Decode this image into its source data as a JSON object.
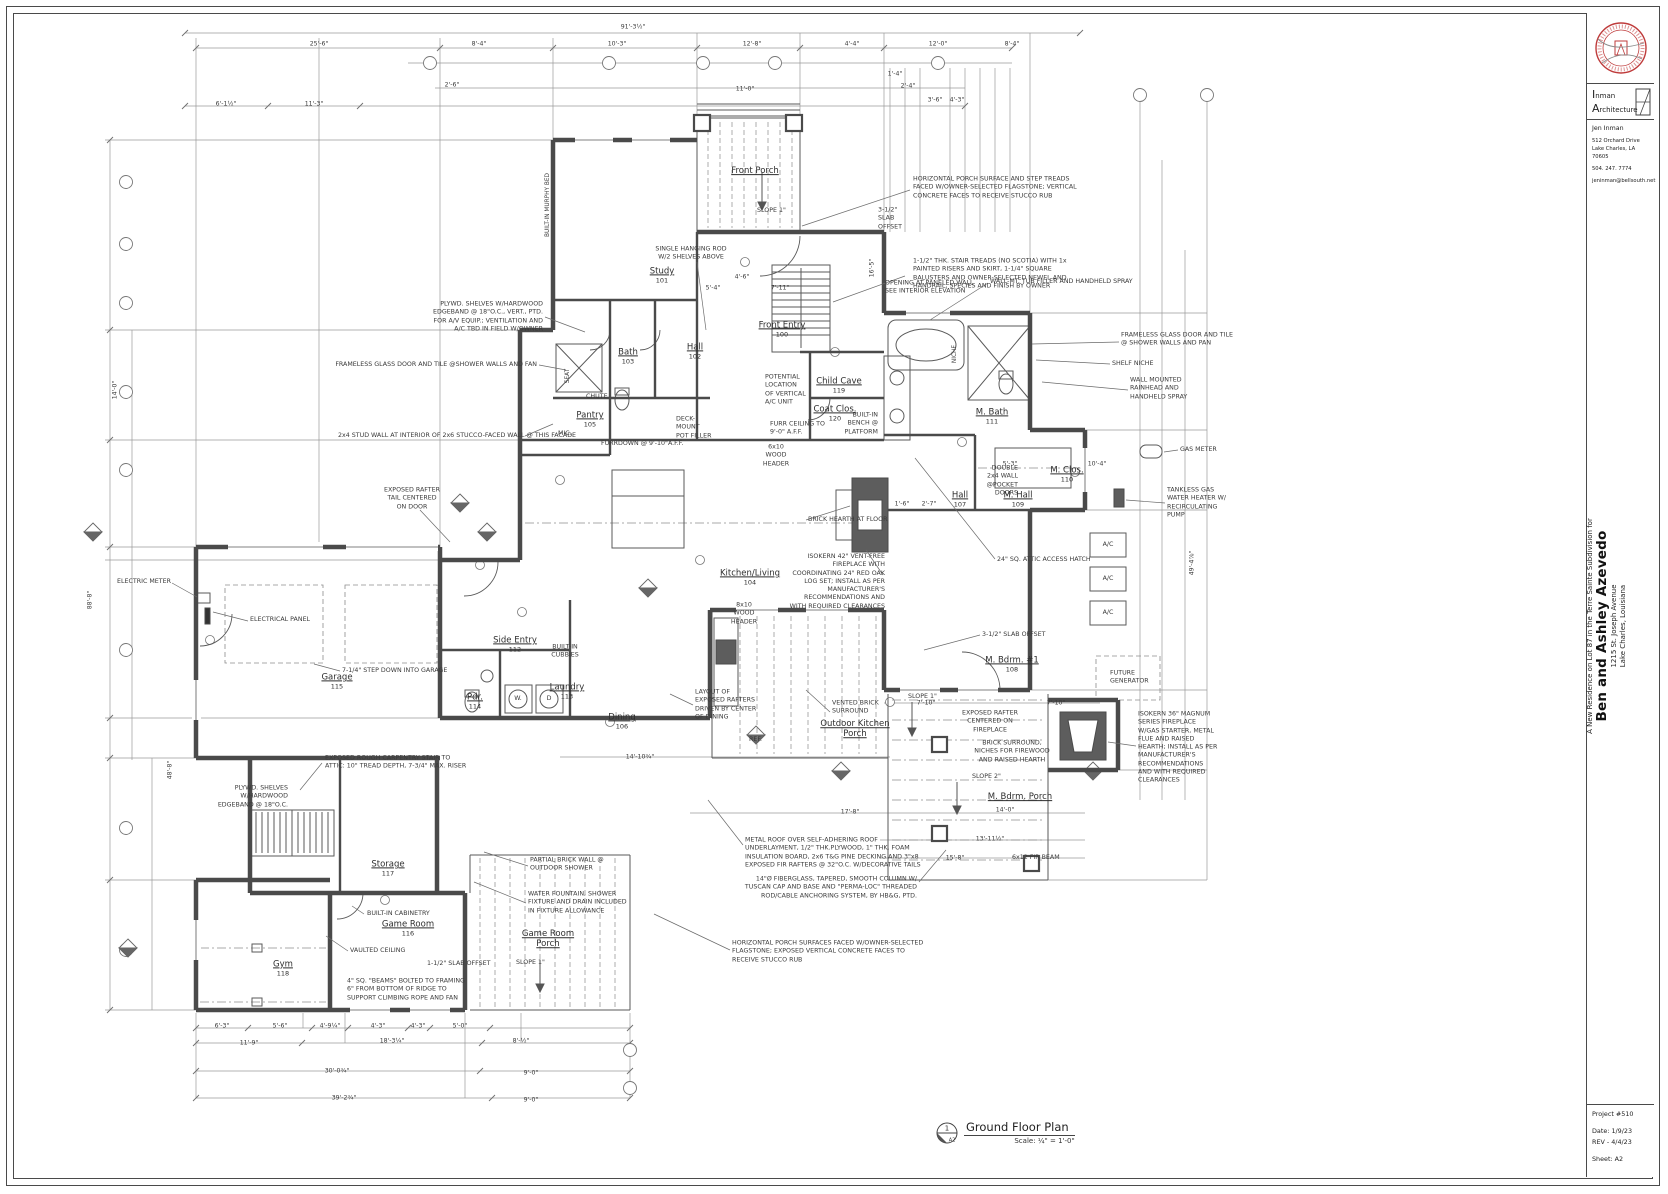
{
  "title_block": {
    "firm_line1": "Inman",
    "firm_line2": "Architecture",
    "architect": "Jen Inman",
    "address1": "512 Orchard Drive",
    "address2": "Lake Charles, LA  70605",
    "phone": "504. 247. 7774",
    "email": "jeninman@bellsouth.net",
    "project_intro": "A New Residence on Lot 87 in the Terre Sainte Subdivision for",
    "client": "Ben and Ashley Azevedo",
    "project_address1": "1215 St. Joseph Avenue",
    "project_address2": "Lake Charles, Louisiana",
    "project_number": "Project #510",
    "date_label": "Date:  1/9/23",
    "rev_label": "REV - 4/4/23",
    "sheet_label": "Sheet:  A2",
    "seal_color": "#bf3b3b"
  },
  "drawing_title": {
    "tag_number": "1",
    "tag_sheet": "A2",
    "title": "Ground Floor Plan",
    "scale": "Scale: ¼\" = 1'-0\""
  },
  "plan": {
    "rooms": [
      {
        "l": [
          "Front Porch"
        ],
        "n": "",
        "x": 755,
        "y": 172
      },
      {
        "l": [
          "Front Entry"
        ],
        "n": "100",
        "x": 782,
        "y": 330
      },
      {
        "l": [
          "Study"
        ],
        "n": "101",
        "x": 662,
        "y": 276
      },
      {
        "l": [
          "Hall"
        ],
        "n": "102",
        "x": 695,
        "y": 352
      },
      {
        "l": [
          "Bath"
        ],
        "n": "103",
        "x": 628,
        "y": 357
      },
      {
        "l": [
          "Kitchen/Living"
        ],
        "n": "104",
        "x": 750,
        "y": 578
      },
      {
        "l": [
          "Pantry"
        ],
        "n": "105",
        "x": 590,
        "y": 420
      },
      {
        "l": [
          "Dining"
        ],
        "n": "106",
        "x": 622,
        "y": 722
      },
      {
        "l": [
          "Hall"
        ],
        "n": "107",
        "x": 960,
        "y": 500
      },
      {
        "l": [
          "M. Bdrm. #1"
        ],
        "n": "108",
        "x": 1012,
        "y": 665
      },
      {
        "l": [
          "M. Hall"
        ],
        "n": "109",
        "x": 1018,
        "y": 500
      },
      {
        "l": [
          "M. Clos."
        ],
        "n": "110",
        "x": 1067,
        "y": 475
      },
      {
        "l": [
          "M. Bath"
        ],
        "n": "111",
        "x": 992,
        "y": 417
      },
      {
        "l": [
          "Side Entry"
        ],
        "n": "112",
        "x": 515,
        "y": 645
      },
      {
        "l": [
          "Laundry"
        ],
        "n": "113",
        "x": 567,
        "y": 692
      },
      {
        "l": [
          "Pdr."
        ],
        "n": "114",
        "x": 475,
        "y": 702
      },
      {
        "l": [
          "Garage"
        ],
        "n": "115",
        "x": 337,
        "y": 682
      },
      {
        "l": [
          "Game Room"
        ],
        "n": "116",
        "x": 408,
        "y": 929
      },
      {
        "l": [
          "Storage"
        ],
        "n": "117",
        "x": 388,
        "y": 869
      },
      {
        "l": [
          "Gym"
        ],
        "n": "118",
        "x": 283,
        "y": 969
      },
      {
        "l": [
          "Child Cave"
        ],
        "n": "119",
        "x": 839,
        "y": 386
      },
      {
        "l": [
          "Coat Clos."
        ],
        "n": "120",
        "x": 835,
        "y": 414
      },
      {
        "l": [
          "Outdoor Kitchen",
          "Porch"
        ],
        "n": "",
        "x": 855,
        "y": 730
      },
      {
        "l": [
          "Game Room",
          "Porch"
        ],
        "n": "",
        "x": 548,
        "y": 940
      },
      {
        "l": [
          "M. Bdrm. Porch"
        ],
        "n": "",
        "x": 1020,
        "y": 798
      }
    ],
    "annotations": [
      {
        "l": [
          "SINGLE HANGING ROD",
          "W/2 SHELVES ABOVE"
        ],
        "x": 691,
        "y": 254,
        "a": "c"
      },
      {
        "l": [
          "PLYWD. SHELVES W/HARDWOOD",
          "EDGEBAND @ 18\"O.C., VERT., PTD.",
          "FOR A/V EQUIP.; VENTILATION AND",
          "A/C TBD IN FIELD W/OWNER"
        ],
        "x": 543,
        "y": 317,
        "a": "r"
      },
      {
        "l": [
          "FRAMELESS GLASS DOOR AND TILE @SHOWER WALLS AND FAN"
        ],
        "x": 537,
        "y": 365,
        "a": "r"
      },
      {
        "l": [
          "2x4 STUD WALL AT INTERIOR OF 2x6 STUCCO-FACED WALL @ THIS FACADE"
        ],
        "x": 338,
        "y": 436,
        "a": "l"
      },
      {
        "l": [
          "HORIZONTAL PORCH SURFACE AND STEP TREADS",
          "FACED W/OWNER-SELECTED FLAGSTONE; VERTICAL",
          "CONCRETE FACES TO RECEIVE STUCCO RUB"
        ],
        "x": 913,
        "y": 188,
        "a": "l"
      },
      {
        "l": [
          "3-1/2\"",
          "SLAB",
          "OFFSET"
        ],
        "x": 878,
        "y": 219,
        "a": "l"
      },
      {
        "l": [
          "1-1/2\" THK. STAIR TREADS (NO SCOTIA) WITH 1x",
          "PAINTED RISERS AND SKIRT, 1-1/4\" SQUARE",
          "BALUSTERS AND OWNER-SELECTED NEWEL AND",
          "HANDRAIL; SPECIES AND FINISH BY OWNER"
        ],
        "x": 913,
        "y": 274,
        "a": "l"
      },
      {
        "l": [
          "OPENING AT PANELED WALL",
          "SEE INTERIOR ELEVATION"
        ],
        "x": 885,
        "y": 288,
        "a": "l"
      },
      {
        "l": [
          "WALL-MT. TUB FILLER AND HANDHELD SPRAY"
        ],
        "x": 990,
        "y": 282,
        "a": "l"
      },
      {
        "l": [
          "FRAMELESS GLASS DOOR AND TILE",
          "@ SHOWER WALLS AND PAN"
        ],
        "x": 1121,
        "y": 340,
        "a": "l"
      },
      {
        "l": [
          "SHELF NICHE"
        ],
        "x": 1112,
        "y": 364,
        "a": "l"
      },
      {
        "l": [
          "WALL MOUNTED",
          "RAINHEAD AND",
          "HANDHELD SPRAY"
        ],
        "x": 1130,
        "y": 389,
        "a": "l"
      },
      {
        "l": [
          "GAS METER"
        ],
        "x": 1180,
        "y": 450,
        "a": "l"
      },
      {
        "l": [
          "TANKLESS GAS",
          "WATER HEATER W/",
          "RECIRCULATING",
          "PUMP"
        ],
        "x": 1167,
        "y": 503,
        "a": "l"
      },
      {
        "l": [
          "POTENTIAL",
          "LOCATION",
          "OF VERTICAL",
          "A/C UNIT"
        ],
        "x": 765,
        "y": 390,
        "a": "l"
      },
      {
        "l": [
          "FURR CEILING TO",
          "9'-0\" A.F.F."
        ],
        "x": 770,
        "y": 429,
        "a": "l"
      },
      {
        "l": [
          "6x10",
          "WOOD",
          "HEADER"
        ],
        "x": 776,
        "y": 456,
        "a": "c"
      },
      {
        "l": [
          "DECK-",
          "MOUNT",
          "POT FILLER"
        ],
        "x": 676,
        "y": 428,
        "a": "l"
      },
      {
        "l": [
          "FURRDOWN @ 9'-10\"A.F.F."
        ],
        "x": 601,
        "y": 444,
        "a": "l"
      },
      {
        "l": [
          "BRICK HEARTH AT FLOOR"
        ],
        "x": 808,
        "y": 520,
        "a": "l"
      },
      {
        "l": [
          "ISOKERN 42\" VENT-FREE",
          "FIREPLACE WITH",
          "COORDINATING 24\" RED OAK",
          "LOG SET; INSTALL AS PER",
          "MANUFACTURER'S",
          "RECOMMENDATIONS AND",
          "WITH REQUIRED CLEARANCES"
        ],
        "x": 885,
        "y": 582,
        "a": "r"
      },
      {
        "l": [
          "24\" SQ. ATTIC ACCESS HATCH"
        ],
        "x": 997,
        "y": 560,
        "a": "l"
      },
      {
        "l": [
          "EXPOSED RAFTER",
          "TAIL CENTERED",
          "ON DOOR"
        ],
        "x": 412,
        "y": 499,
        "a": "c"
      },
      {
        "l": [
          "ELECTRIC METER"
        ],
        "x": 117,
        "y": 582,
        "a": "l"
      },
      {
        "l": [
          "ELECTRICAL PANEL"
        ],
        "x": 250,
        "y": 620,
        "a": "l"
      },
      {
        "l": [
          "7-1/4\" STEP DOWN INTO GARAGE"
        ],
        "x": 342,
        "y": 671,
        "a": "l"
      },
      {
        "l": [
          "EXPOSED ROUGH CARPENTRY STAIR TO",
          "ATTIC: 10\" TREAD DEPTH, 7-3/4\" MAX. RISER"
        ],
        "x": 325,
        "y": 763,
        "a": "l"
      },
      {
        "l": [
          "8x10",
          "WOOD",
          "HEADER"
        ],
        "x": 744,
        "y": 614,
        "a": "c"
      },
      {
        "l": [
          "LAYOUT OF",
          "EXPOSED RAFTERS",
          "DRIVEN BY CENTER",
          "OF DINING"
        ],
        "x": 695,
        "y": 705,
        "a": "l"
      },
      {
        "l": [
          "3-1/2\" SLAB OFFSET"
        ],
        "x": 982,
        "y": 635,
        "a": "l"
      },
      {
        "l": [
          "VENTED BRICK",
          "SURROUND"
        ],
        "x": 832,
        "y": 708,
        "a": "l"
      },
      {
        "l": [
          "EXPOSED RAFTER",
          "CENTERED ON",
          "FIREPLACE"
        ],
        "x": 990,
        "y": 722,
        "a": "c"
      },
      {
        "l": [
          "BRICK SURROUND,",
          "NICHES FOR FIREWOOD",
          "AND RAISED HEARTH"
        ],
        "x": 1012,
        "y": 752,
        "a": "c"
      },
      {
        "l": [
          "SLOPE 2\""
        ],
        "x": 972,
        "y": 777,
        "a": "l"
      },
      {
        "l": [
          "SLOPE 1\""
        ],
        "x": 908,
        "y": 697,
        "a": "l"
      },
      {
        "l": [
          "SLOPE 1\""
        ],
        "x": 757,
        "y": 211,
        "a": "l"
      },
      {
        "l": [
          "SLOPE 1\""
        ],
        "x": 516,
        "y": 963,
        "a": "l"
      },
      {
        "l": [
          "PLYWD. SHELVES",
          "W/HARDWOOD",
          "EDGEBAND @ 18\"O.C."
        ],
        "x": 288,
        "y": 797,
        "a": "r"
      },
      {
        "l": [
          "PARTIAL BRICK WALL @",
          "OUTDOOR SHOWER"
        ],
        "x": 530,
        "y": 865,
        "a": "l"
      },
      {
        "l": [
          "WATER FOUNTAIN, SHOWER",
          "FIXTURE AND DRAIN INCLUDED",
          "IN FIXTURE ALLOWANCE"
        ],
        "x": 528,
        "y": 903,
        "a": "l"
      },
      {
        "l": [
          "BUILT-IN CABINETRY"
        ],
        "x": 367,
        "y": 914,
        "a": "l"
      },
      {
        "l": [
          "VAULTED CEILING"
        ],
        "x": 350,
        "y": 951,
        "a": "l"
      },
      {
        "l": [
          "4\" SQ. \"BEAMS\" BOLTED TO FRAMING",
          "6\" FROM BOTTOM OF RIDGE TO",
          "SUPPORT CLIMBING ROPE AND FAN"
        ],
        "x": 347,
        "y": 990,
        "a": "l"
      },
      {
        "l": [
          "1-1/2\" SLAB OFFSET"
        ],
        "x": 427,
        "y": 964,
        "a": "l"
      },
      {
        "l": [
          "METAL ROOF OVER SELF-ADHERING ROOF",
          "UNDERLAYMENT, 1/2\" THK.PLYWOOD, 1\" THK. FOAM",
          "INSULATION BOARD, 2x6 T&G PINE DECKING AND 3\"x8",
          "EXPOSED FIR RAFTERS @ 32\"O.C. W/DECORATIVE TAILS"
        ],
        "x": 745,
        "y": 853,
        "a": "l"
      },
      {
        "l": [
          "14\"Ø FIBERGLASS, TAPERED, SMOOTH COLUMN W/",
          "TUSCAN CAP AND BASE AND \"PERMA-LOC\" THREADED",
          "ROD/CABLE ANCHORING SYSTEM, BY HB&G, PTD."
        ],
        "x": 917,
        "y": 888,
        "a": "r"
      },
      {
        "l": [
          "HORIZONTAL PORCH SURFACES FACED W/OWNER-SELECTED",
          "FLAGSTONE; EXPOSED VERTICAL CONCRETE FACES TO",
          "RECEIVE STUCCO RUB"
        ],
        "x": 732,
        "y": 952,
        "a": "l"
      },
      {
        "l": [
          "ISOKERN 36\" MAGNUM",
          "SERIES FIREPLACE",
          "W/GAS STARTER, METAL",
          "FLUE AND RAISED",
          "HEARTH; INSTALL AS PER",
          "MANUFACTURER'S",
          "RECOMMENDATIONS",
          "AND WITH REQUIRED",
          "CLEARANCES"
        ],
        "x": 1138,
        "y": 748,
        "a": "l"
      },
      {
        "l": [
          "FUTURE",
          "GENERATOR"
        ],
        "x": 1110,
        "y": 678,
        "a": "l"
      },
      {
        "l": [
          "6x12 FIR BEAM"
        ],
        "x": 1012,
        "y": 858,
        "a": "l"
      },
      {
        "l": [
          "DOUBLE",
          "2x4 WALL",
          "@POCKET",
          "DOORS"
        ],
        "x": 1018,
        "y": 481,
        "a": "r"
      },
      {
        "l": [
          "BUILT-IN",
          "CUBBIES"
        ],
        "x": 565,
        "y": 652,
        "a": "c"
      },
      {
        "l": [
          "BUILT-IN",
          "BENCH @",
          "PLATFORM"
        ],
        "x": 878,
        "y": 424,
        "a": "r"
      },
      {
        "l": [
          "A/C"
        ],
        "x": 1108,
        "y": 545,
        "a": "c"
      },
      {
        "l": [
          "A/C"
        ],
        "x": 1108,
        "y": 579,
        "a": "c"
      },
      {
        "l": [
          "A/C"
        ],
        "x": 1108,
        "y": 613,
        "a": "c"
      },
      {
        "l": [
          "REF."
        ],
        "x": 749,
        "y": 740,
        "a": "l"
      },
      {
        "l": [
          "MIC."
        ],
        "x": 558,
        "y": 434,
        "a": "l"
      },
      {
        "l": [
          "CHUTE"
        ],
        "x": 586,
        "y": 397,
        "a": "l"
      },
      {
        "l": [
          "W."
        ],
        "x": 518,
        "y": 699,
        "a": "c"
      },
      {
        "l": [
          "D"
        ],
        "x": 549,
        "y": 699,
        "a": "c"
      }
    ],
    "dimensions": [
      {
        "t": "91'-3½\"",
        "x": 633,
        "y": 27
      },
      {
        "t": "25'-6\"",
        "x": 319,
        "y": 44
      },
      {
        "t": "8'-4\"",
        "x": 479,
        "y": 44
      },
      {
        "t": "10'-3\"",
        "x": 617,
        "y": 44
      },
      {
        "t": "12'-8\"",
        "x": 752,
        "y": 44
      },
      {
        "t": "4'-4\"",
        "x": 852,
        "y": 44
      },
      {
        "t": "12'-0\"",
        "x": 938,
        "y": 44
      },
      {
        "t": "8'-4\"",
        "x": 1012,
        "y": 44
      },
      {
        "t": "2'-6\"",
        "x": 452,
        "y": 85
      },
      {
        "t": "11'-0\"",
        "x": 745,
        "y": 89
      },
      {
        "t": "6'-1½\"",
        "x": 226,
        "y": 104
      },
      {
        "t": "11'-3\"",
        "x": 314,
        "y": 104
      },
      {
        "t": "1'-4\"",
        "x": 895,
        "y": 74
      },
      {
        "t": "2'-4\"",
        "x": 908,
        "y": 86
      },
      {
        "t": "3'-6\"",
        "x": 935,
        "y": 100
      },
      {
        "t": "4'-3\"",
        "x": 957,
        "y": 100
      },
      {
        "t": "5'-4\"",
        "x": 713,
        "y": 288
      },
      {
        "t": "7'-11\"",
        "x": 780,
        "y": 288
      },
      {
        "t": "4'-6\"",
        "x": 742,
        "y": 277
      },
      {
        "t": "1'-6\"",
        "x": 902,
        "y": 504
      },
      {
        "t": "2'-7\"",
        "x": 929,
        "y": 504
      },
      {
        "t": "5'-3\"",
        "x": 1010,
        "y": 464
      },
      {
        "t": "10'-4\"",
        "x": 1097,
        "y": 464
      },
      {
        "t": "7'-10\"",
        "x": 926,
        "y": 703
      },
      {
        "t": "7'-10\"",
        "x": 1056,
        "y": 703
      },
      {
        "t": "14'-10¾\"",
        "x": 640,
        "y": 757
      },
      {
        "t": "17'-8\"",
        "x": 850,
        "y": 812
      },
      {
        "t": "14'-0\"",
        "x": 1005,
        "y": 810
      },
      {
        "t": "13'-11½\"",
        "x": 990,
        "y": 839
      },
      {
        "t": "15'-8\"",
        "x": 955,
        "y": 858
      },
      {
        "t": "6'-3\"",
        "x": 222,
        "y": 1026
      },
      {
        "t": "5'-6\"",
        "x": 280,
        "y": 1026
      },
      {
        "t": "4'-9¼\"",
        "x": 330,
        "y": 1026
      },
      {
        "t": "4'-3\"",
        "x": 378,
        "y": 1026
      },
      {
        "t": "4'-3\"",
        "x": 418,
        "y": 1026
      },
      {
        "t": "5'-0\"",
        "x": 460,
        "y": 1026
      },
      {
        "t": "11'-9\"",
        "x": 249,
        "y": 1043
      },
      {
        "t": "18'-3¼\"",
        "x": 392,
        "y": 1041
      },
      {
        "t": "8'-½\"",
        "x": 521,
        "y": 1041
      },
      {
        "t": "30'-0¾\"",
        "x": 337,
        "y": 1071
      },
      {
        "t": "9'-0\"",
        "x": 531,
        "y": 1073
      },
      {
        "t": "39'-2¾\"",
        "x": 344,
        "y": 1098
      },
      {
        "t": "9'-0\"",
        "x": 531,
        "y": 1100
      },
      {
        "t": "88'-8\"",
        "x": 90,
        "y": 600,
        "r": -90
      },
      {
        "t": "48'-8\"",
        "x": 170,
        "y": 770,
        "r": -90
      },
      {
        "t": "14'-0\"",
        "x": 115,
        "y": 390,
        "r": -90
      },
      {
        "t": "16'-5\"",
        "x": 872,
        "y": 268,
        "r": -90
      },
      {
        "t": "49'-4⅞\"",
        "x": 1192,
        "y": 563,
        "r": -90
      }
    ],
    "vertical_labels": [
      {
        "t": "BUILT-IN MURPHY BED",
        "x": 548,
        "y": 205
      },
      {
        "t": "NICHE",
        "x": 955,
        "y": 354
      },
      {
        "t": "SEAT",
        "x": 568,
        "y": 376
      }
    ]
  }
}
